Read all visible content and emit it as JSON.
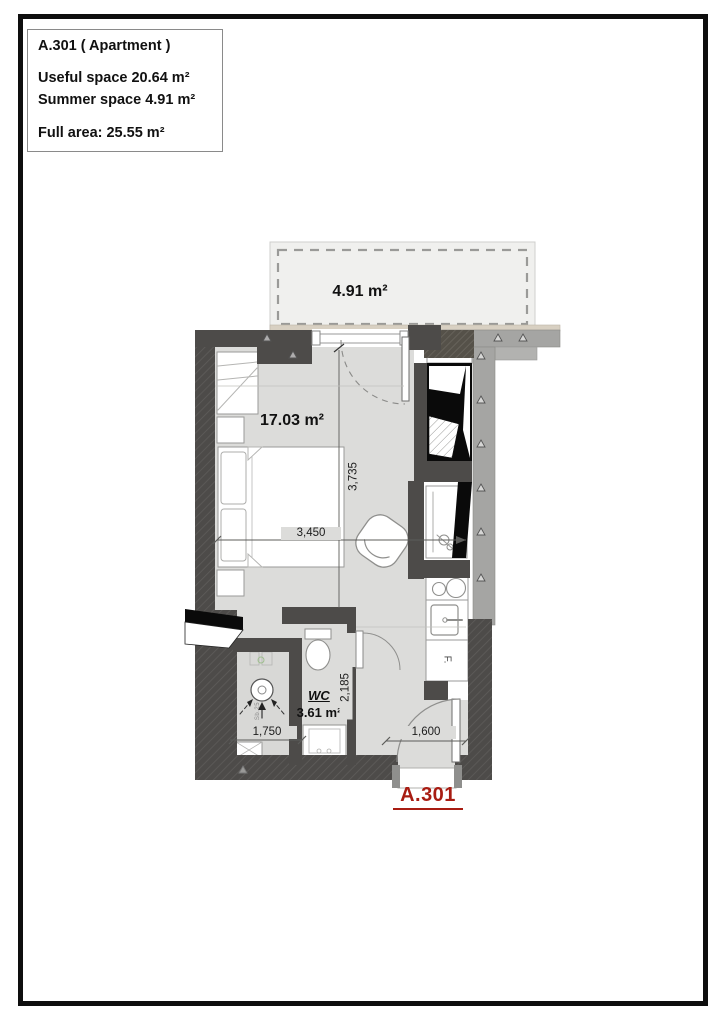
{
  "title_block": {
    "title": "A.301 ( Apartment )",
    "useful_space": "Useful space 20.64 m²",
    "summer_space": "Summer space 4.91 m²",
    "full_area": "Full area: 25.55 m²"
  },
  "plan": {
    "terrace_area": "4.91 m²",
    "room_area": "17.03 m²",
    "wc_name": "WC",
    "wc_area": "3.61 m²",
    "apartment_number": "A.301",
    "fridge_label": "F.",
    "shaft_label": "Sb.25",
    "dimensions": {
      "room_width": "3,450",
      "room_depth": "3,735",
      "wc_depth": "2,185",
      "shaft_width": "1,750",
      "entry_width": "1,600"
    },
    "colors": {
      "wall_dark": "#4d4b49",
      "wall_gray": "#a5a5a3",
      "floor_gray": "#dcdcda",
      "terrace_gray": "#f0f0ee",
      "accent_red": "#a81c12"
    }
  }
}
